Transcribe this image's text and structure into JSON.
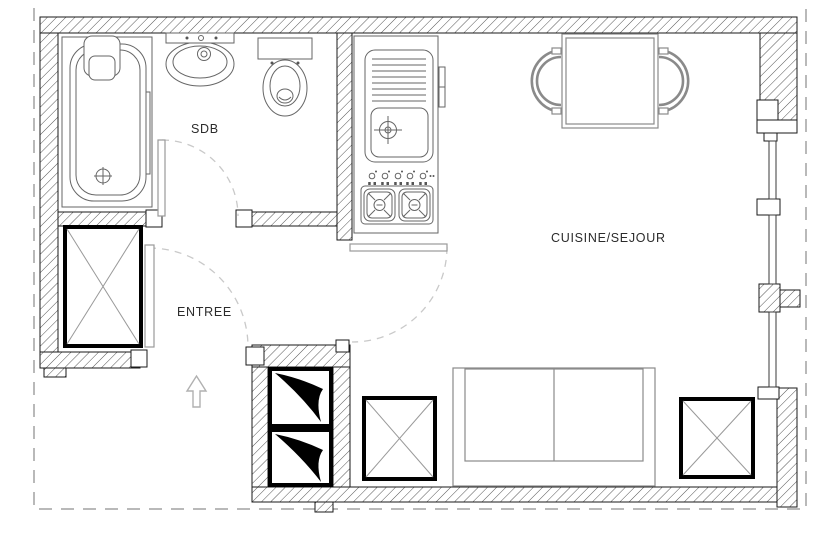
{
  "title": "Plan studio",
  "rooms": {
    "bathroom": "SDB",
    "entrance": "ENTREE",
    "kitchen_living": "CUISINE/SEJOUR"
  },
  "fixtures": [
    "bathtub",
    "washbasin",
    "toilet",
    "kitchen-sink-unit",
    "gas-hob",
    "dining-table",
    "dining-chairs",
    "sofa-bed",
    "wardrobe",
    "ventilation-duct",
    "window-wall",
    "door-swing",
    "entrance-arrow"
  ],
  "colors": {
    "outline": "#1a1a1a",
    "wall_hatch": "#555555",
    "fixture_line": "#666666",
    "furniture_line": "#8a8a8a",
    "duct_fill": "#000000",
    "boundary_dash": "#b9b9b9",
    "door_swing_dash": "#c9c9c9",
    "label_text": "#2b2b2b"
  }
}
